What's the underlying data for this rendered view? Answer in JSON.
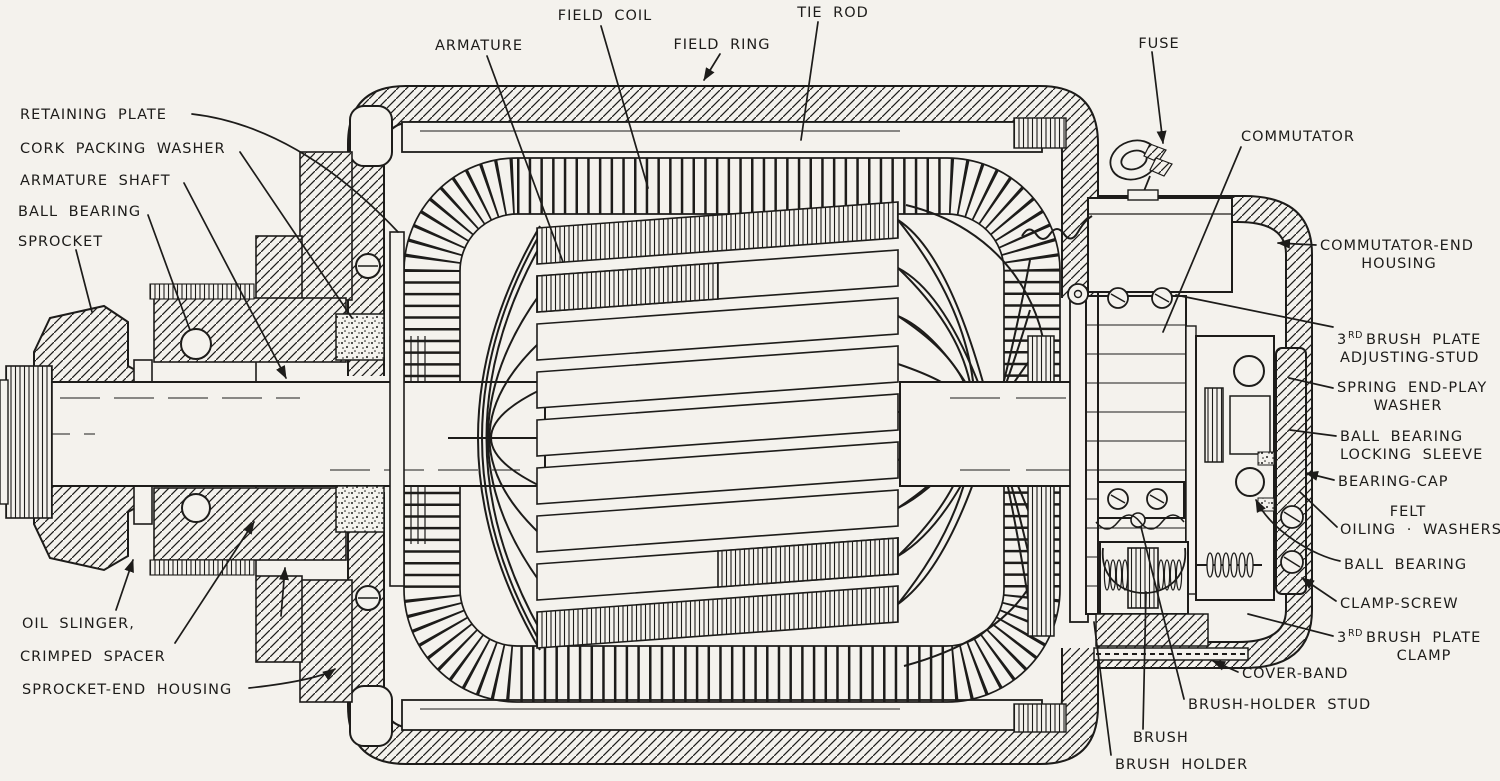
{
  "figure": {
    "type": "cutaway technical line illustration",
    "subject": "Sectional view of an electric motor / generator showing internal parts"
  },
  "palette": {
    "paper": "#f4f2ed",
    "ink": "#1d1c1a"
  },
  "labels": {
    "field_coil": {
      "text": "FIELD COIL"
    },
    "tie_rod": {
      "text": "TIE ROD"
    },
    "armature": {
      "text": "ARMATURE"
    },
    "field_ring": {
      "text": "FIELD RING"
    },
    "fuse": {
      "text": "FUSE"
    },
    "commutator": {
      "text": "COMMUTATOR"
    },
    "retaining_plate": {
      "text": "RETAINING PLATE"
    },
    "cork_packing_washer": {
      "text": "CORK PACKING WASHER"
    },
    "armature_shaft": {
      "text": "ARMATURE SHAFT"
    },
    "ball_bearing_left": {
      "text": "BALL BEARING"
    },
    "sprocket": {
      "text": "SPROCKET"
    },
    "oil_slinger": {
      "text": "OIL SLINGER,"
    },
    "crimped_spacer": {
      "text": "CRIMPED SPACER"
    },
    "sprocket_end_housing": {
      "text": "SPROCKET-END HOUSING"
    },
    "commutator_end_housing": {
      "line1": "COMMUTATOR-END",
      "line2": "HOUSING"
    },
    "third_brush_plate_adjusting_stud": {
      "num": "3",
      "sup": "RD",
      "rest": "BRUSH PLATE",
      "line2": "ADJUSTING-STUD"
    },
    "spring_end_play_washer": {
      "line1": "SPRING END-PLAY",
      "line2": "WASHER"
    },
    "ball_bearing_locking_sleeve": {
      "line1": "BALL BEARING",
      "line2": "LOCKING SLEEVE"
    },
    "bearing_cap": {
      "text": "BEARING-CAP"
    },
    "felt_oiling_washers": {
      "line1": "FELT",
      "line2": "OILING · WASHERS"
    },
    "ball_bearing_right": {
      "text": "BALL BEARING"
    },
    "clamp_screw": {
      "text": "CLAMP-SCREW"
    },
    "third_brush_plate_clamp": {
      "num": "3",
      "sup": "RD",
      "rest": "BRUSH PLATE",
      "line2": "CLAMP"
    },
    "cover_band": {
      "text": "COVER-BAND"
    },
    "brush_holder_stud": {
      "text": "BRUSH-HOLDER STUD"
    },
    "brush": {
      "text": "BRUSH"
    },
    "brush_holder": {
      "text": "BRUSH HOLDER"
    }
  }
}
